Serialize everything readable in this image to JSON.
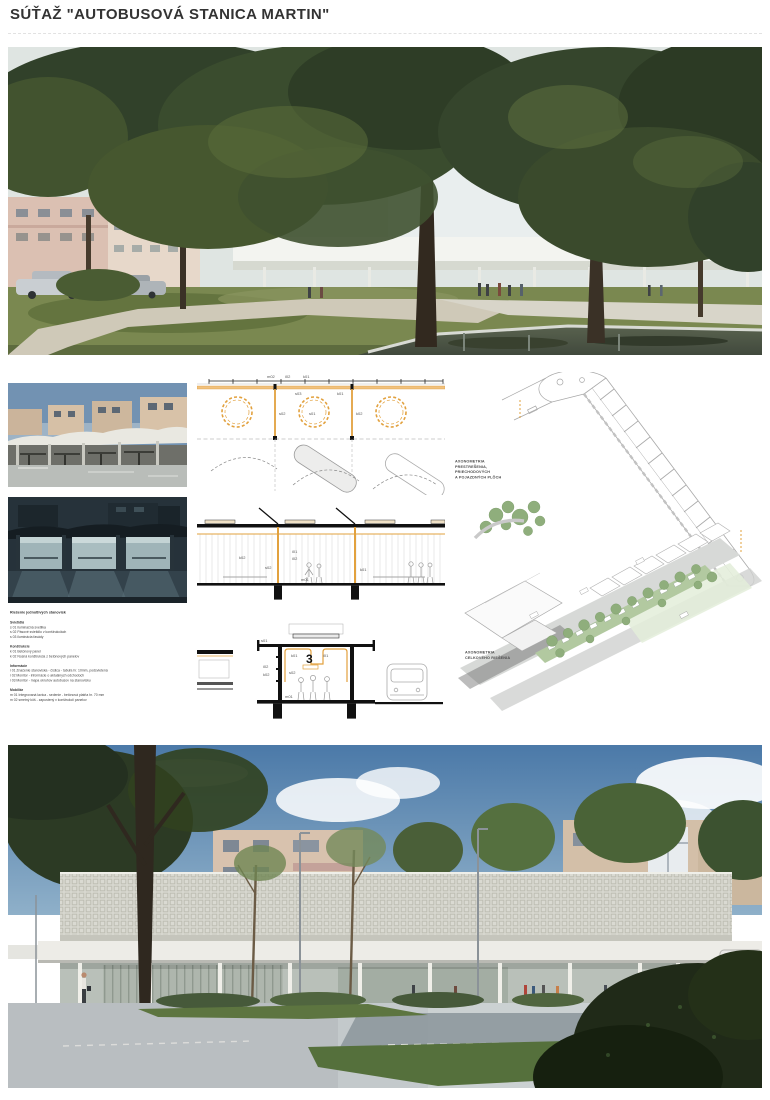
{
  "page": {
    "title": "SÚŤAŽ \"AUTOBUSOVÁ STANICA MARTIN\""
  },
  "accent": {
    "orange": "#E2A13E",
    "drawing_gray": "#9a9a9a",
    "green": "#8FB07C"
  },
  "axonometry": {
    "label_top": "AXONOMETRIA\nPRESTREŠENIA,\nPRIECHODOVÝCH\nA POJAZDNÝCH PLÔCH",
    "label_bottom": "AXONOMETRIA\nCELKOVÉHO RIEŠENIA"
  },
  "legend": {
    "heading": "Riešenie jednotlivých stanovísk",
    "sections": [
      {
        "title": "Svietidlá",
        "items": [
          "s 01 iluminačná svetilka",
          "s 02 Pásové svietidlo v konštrukciách",
          "s 03 iluminácia fasády"
        ]
      },
      {
        "title": "Konštrukcie",
        "items": [
          "k 01 Betónový panel",
          "k 02 Nosná konštrukcia z betónových panelov"
        ]
      },
      {
        "title": "Informácie",
        "items": [
          "i 01 Značenie stanoviska - číslica - tabuľa hr. 10mm, podsvietená",
          "i 02 Monitor - informácie o aktuálnych odchodoch",
          "i 03 Monitor - mapa okruhov autobusov na stanovisku"
        ]
      },
      {
        "title": "Mobiliár",
        "items": [
          "m 01 Integrovaná lavica - sedenie - betónová platňa hr. 70 mm",
          "m 02 smetný kôš - zapustený v konštrukcii panelov"
        ]
      }
    ]
  },
  "drawings": {
    "plan_codes": [
      "m02",
      "i02",
      "k01",
      "s03",
      "k01",
      "s02",
      "s01",
      "k02"
    ],
    "section_codes": [
      "k02",
      "i01",
      "i02",
      "s02",
      "m01",
      "k01"
    ],
    "detail_codes": [
      "s01",
      "k01",
      "i01",
      "i02",
      "k02",
      "s02",
      "m01"
    ],
    "detail_platform_number": "3"
  },
  "bottom_render": {
    "platform_number": "1"
  }
}
